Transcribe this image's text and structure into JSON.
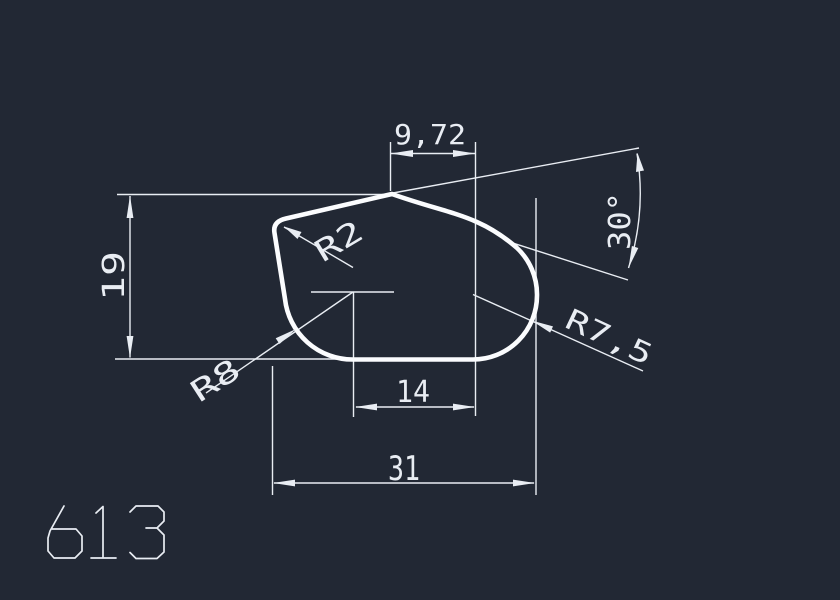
{
  "background_color": "#222834",
  "line_color": "#e9edf3",
  "outline_color": "#fbfcfe",
  "drawing_label": "613",
  "dims": {
    "top_width": "9,72",
    "angle": "30°",
    "height": "19",
    "corner_radius": "R2",
    "bottom_left_radius": "R8",
    "right_radius": "R7,5",
    "inner_width": "14",
    "overall_width": "31"
  }
}
